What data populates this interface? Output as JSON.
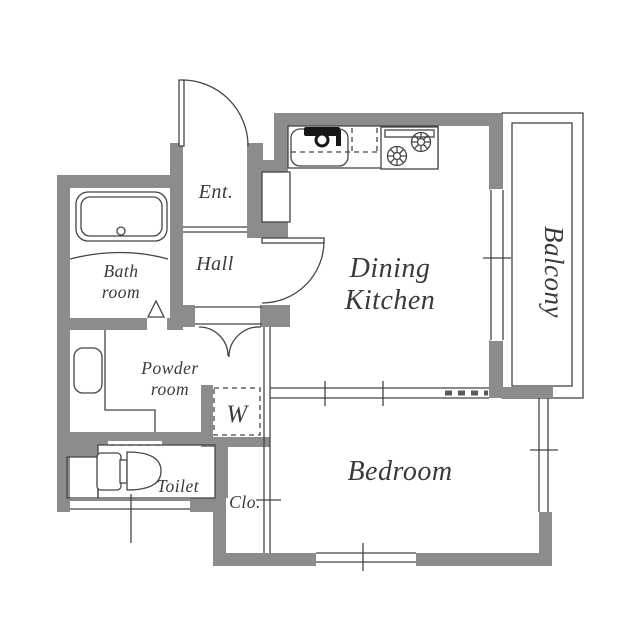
{
  "colors": {
    "wall": "#8c8c8c",
    "line": "#454545",
    "text": "#3a3a3a",
    "background": "#ffffff"
  },
  "rooms": {
    "entrance": {
      "label": "Ent."
    },
    "hall": {
      "label": "Hall"
    },
    "bathroom": {
      "label": "Bath room",
      "lines": [
        "Bath",
        "room"
      ]
    },
    "powder_room": {
      "label": "Powder room",
      "lines": [
        "Powder",
        "room"
      ]
    },
    "toilet": {
      "label": "Toilet"
    },
    "laundry_space": {
      "label": "W"
    },
    "closet": {
      "label": "Clo."
    },
    "dining_kitchen": {
      "label": "Dining Kitchen",
      "lines": [
        "Dining",
        "Kitchen"
      ]
    },
    "bedroom": {
      "label": "Bedroom"
    },
    "balcony": {
      "label": "Balcony"
    }
  },
  "fixtures": [
    "bathtub",
    "vanity-sink",
    "toilet",
    "washing-machine-space",
    "kitchen-sink",
    "gas-stove",
    "shoe-cabinet"
  ]
}
